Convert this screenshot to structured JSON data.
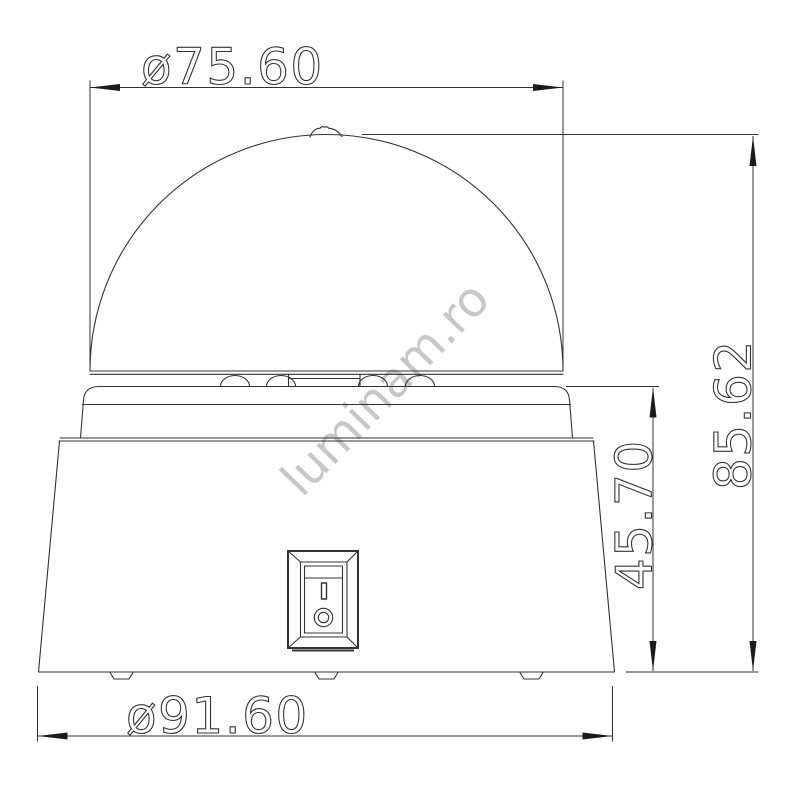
{
  "drawing": {
    "watermark": "luminam.ro",
    "dimensions": {
      "dome_diameter": "ø75.60",
      "total_height": "85.62",
      "base_height": "45.70",
      "base_diameter": "ø91.60"
    },
    "switch": {
      "on_symbol": "I",
      "off_symbol": "O"
    },
    "colors": {
      "line": "#333333",
      "arrow": "#1a1a1a",
      "watermark": "#c7c7c7",
      "background": "#ffffff"
    }
  }
}
